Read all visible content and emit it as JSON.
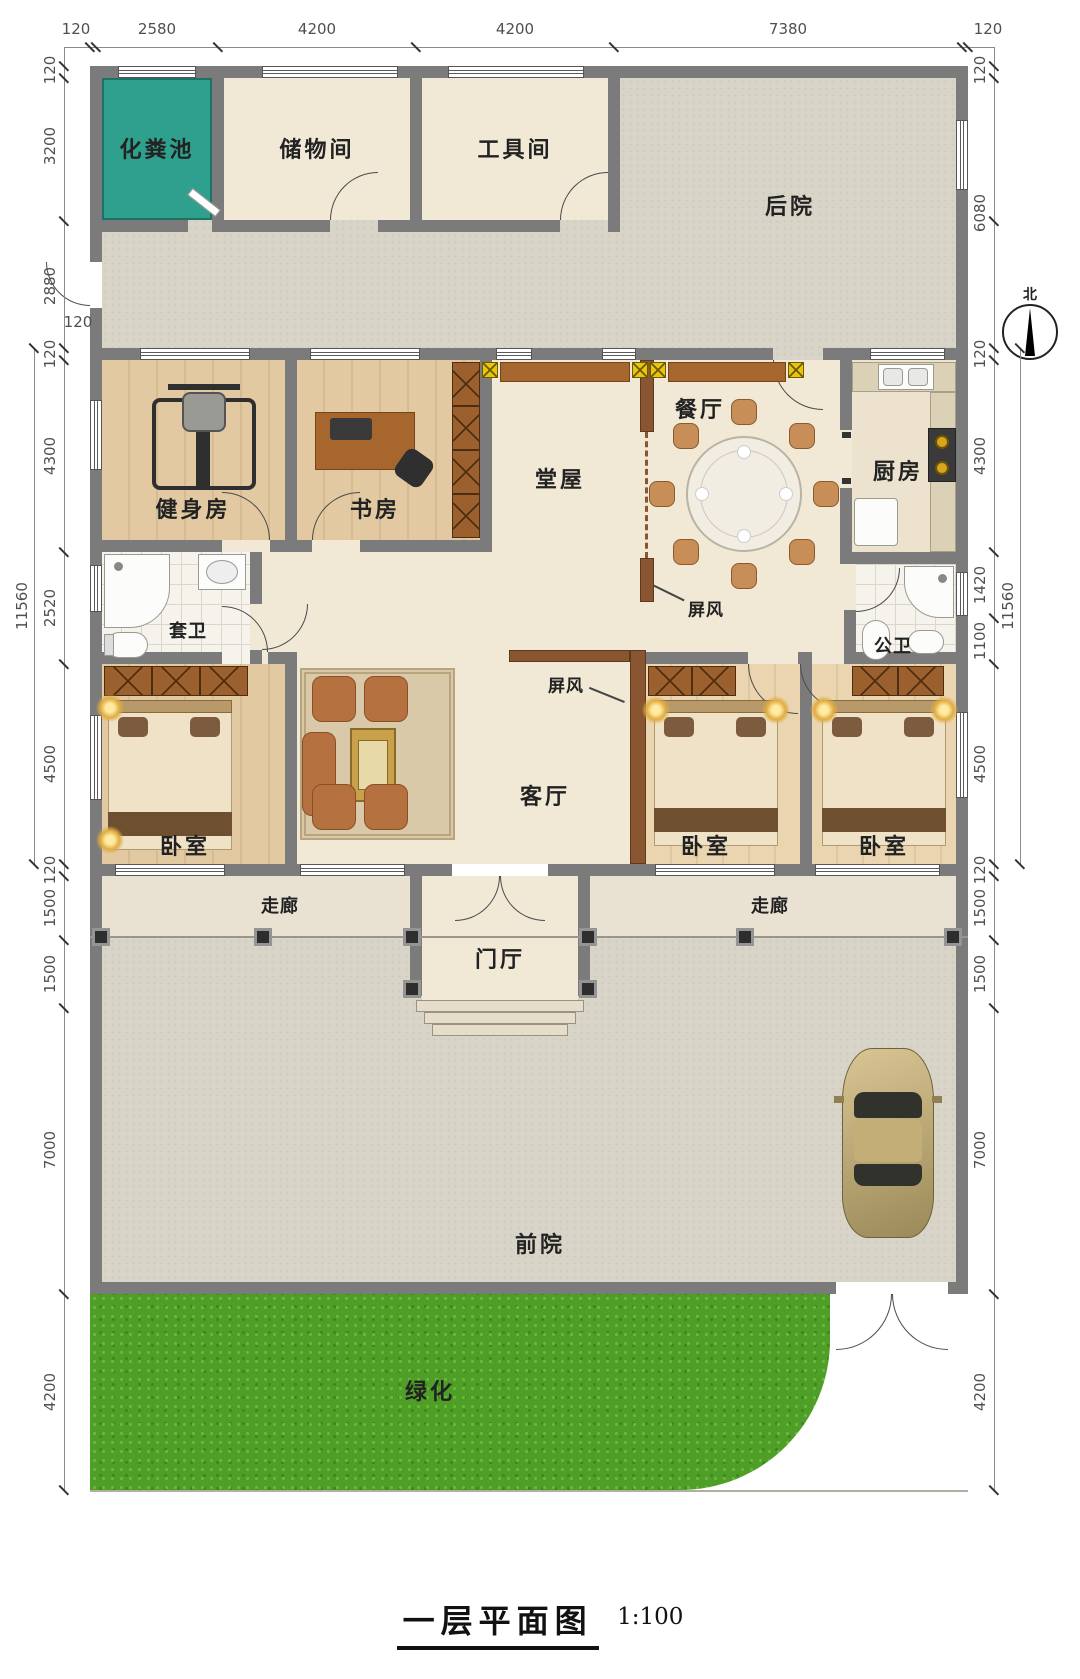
{
  "title": {
    "text": "一层平面图",
    "scale": "1:100"
  },
  "compass": {
    "north": "北"
  },
  "rooms": {
    "septic_tank": "化粪池",
    "storage_room": "储物间",
    "tool_room": "工具间",
    "backyard": "后院",
    "gym": "健身房",
    "study": "书房",
    "main_hall": "堂屋",
    "dining_room": "餐厅",
    "kitchen": "厨房",
    "ensuite_bath": "套卫",
    "public_bath": "公卫",
    "living_room": "客厅",
    "bedroom": "卧室",
    "corridor": "走廊",
    "foyer": "门厅",
    "front_yard": "前院",
    "greenery": "绿化",
    "screen": "屏风"
  },
  "dimensions": {
    "top": [
      "120",
      "2580",
      "4200",
      "4200",
      "7380",
      "120"
    ],
    "left": [
      "120",
      "3200",
      "2880",
      "120",
      "120",
      "4300",
      "2520",
      "4500",
      "11560",
      "120",
      "1500",
      "1500",
      "7000",
      "4200"
    ],
    "right": [
      "120",
      "6080",
      "120",
      "4300",
      "1420",
      "1100",
      "4500",
      "11560",
      "120",
      "1500",
      "1500",
      "7000",
      "4200"
    ]
  }
}
